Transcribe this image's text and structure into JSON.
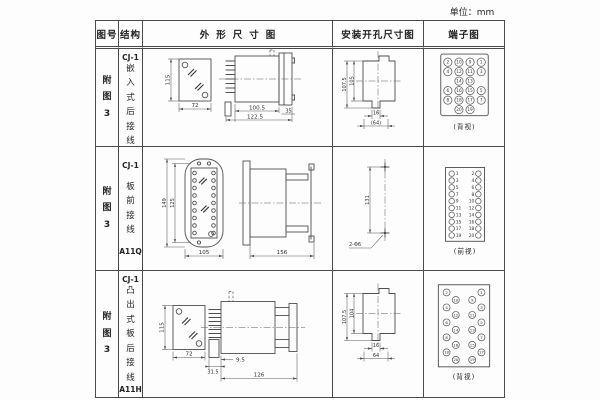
{
  "page": {
    "unit_label": "单位：mm"
  },
  "table": {
    "headers": {
      "figure": "图号",
      "structure": "结构",
      "outline": "外形尺寸图",
      "mounting": "安装开孔尺寸图",
      "terminal": "端子图"
    },
    "rows": [
      {
        "figure_no": "附图3",
        "structure": {
          "model": "CJ-1",
          "desc": "嵌入式后接线",
          "code": "A11K"
        },
        "outline": {
          "front_h": "115",
          "front_w": "72",
          "depth_body": "100.5",
          "depth_total": "122.5",
          "flange_w": "35"
        },
        "mounting": {
          "outer_h": "107.5",
          "inner_h": "105",
          "notch_w": "16",
          "cutout_w": "(64)"
        },
        "terminal": {
          "view": "(背视)",
          "mode": "incircle",
          "items": [
            [
              0,
              0,
              "2"
            ],
            [
              1,
              0,
              "10"
            ],
            [
              2,
              0,
              "9"
            ],
            [
              3,
              0,
              "1"
            ],
            [
              0,
              1,
              "4"
            ],
            [
              1,
              1,
              "12"
            ],
            [
              2,
              1,
              "11"
            ],
            [
              3,
              1,
              "3"
            ],
            [
              1,
              2,
              "14"
            ],
            [
              2,
              2,
              "13"
            ],
            [
              0,
              3,
              "6"
            ],
            [
              1,
              3,
              "16"
            ],
            [
              2,
              3,
              "15"
            ],
            [
              3,
              3,
              "5"
            ],
            [
              0,
              4,
              "8"
            ],
            [
              1,
              4,
              "18"
            ],
            [
              2,
              4,
              "17"
            ],
            [
              3,
              4,
              "7"
            ],
            [
              1,
              5,
              "20"
            ],
            [
              2,
              5,
              "19"
            ]
          ]
        }
      },
      {
        "figure_no": "附图3",
        "structure": {
          "model": "CJ-1",
          "desc": "板前接线",
          "code": "A11Q"
        },
        "outline": {
          "front_h_outer": "149",
          "front_h_inner": "125",
          "front_w": "105",
          "depth": "156"
        },
        "mounting": {
          "hole_spacing": "131",
          "hole_label": "2-Φ6"
        },
        "terminal": {
          "view": "(前视)",
          "mode": "beside",
          "pairs": [
            [
              "1",
              "2"
            ],
            [
              "3",
              "4"
            ],
            [
              "5",
              "6"
            ],
            [
              "7",
              "8"
            ],
            [
              "9",
              "10"
            ],
            [
              "11",
              "12"
            ],
            [
              "13",
              "14"
            ],
            [
              "15",
              "16"
            ],
            [
              "17",
              "18"
            ],
            [
              "19",
              "20"
            ]
          ]
        }
      },
      {
        "figure_no": "附图3",
        "structure": {
          "model": "CJ-1",
          "desc": "凸出式板后接线",
          "code": "A11H"
        },
        "outline": {
          "front_h": "115",
          "front_w": "72",
          "stud_d": "31.5",
          "gap": "9.5",
          "depth": "126"
        },
        "mounting": {
          "outer_h": "107.5",
          "inner_h": "104",
          "notch_w": "16",
          "cutout_w": "64"
        },
        "terminal": {
          "view": "(背视)",
          "mode": "incircle",
          "items": [
            [
              0,
              0,
              "2"
            ],
            [
              3,
              0,
              "1"
            ],
            [
              1,
              1,
              "10"
            ],
            [
              2,
              1,
              "9"
            ],
            [
              0,
              2,
              "4"
            ],
            [
              3,
              2,
              "3"
            ],
            [
              1,
              3,
              "12"
            ],
            [
              2,
              3,
              "11"
            ],
            [
              0,
              4,
              "6"
            ],
            [
              3,
              4,
              "5"
            ],
            [
              1,
              5,
              "14"
            ],
            [
              2,
              5,
              "13"
            ],
            [
              0,
              6,
              "8"
            ],
            [
              3,
              6,
              "7"
            ],
            [
              1,
              7,
              "16"
            ],
            [
              2,
              7,
              "15"
            ],
            [
              0,
              8,
              "18"
            ],
            [
              3,
              8,
              "17"
            ],
            [
              1,
              9,
              "20"
            ],
            [
              2,
              9,
              "19"
            ]
          ]
        }
      }
    ]
  }
}
